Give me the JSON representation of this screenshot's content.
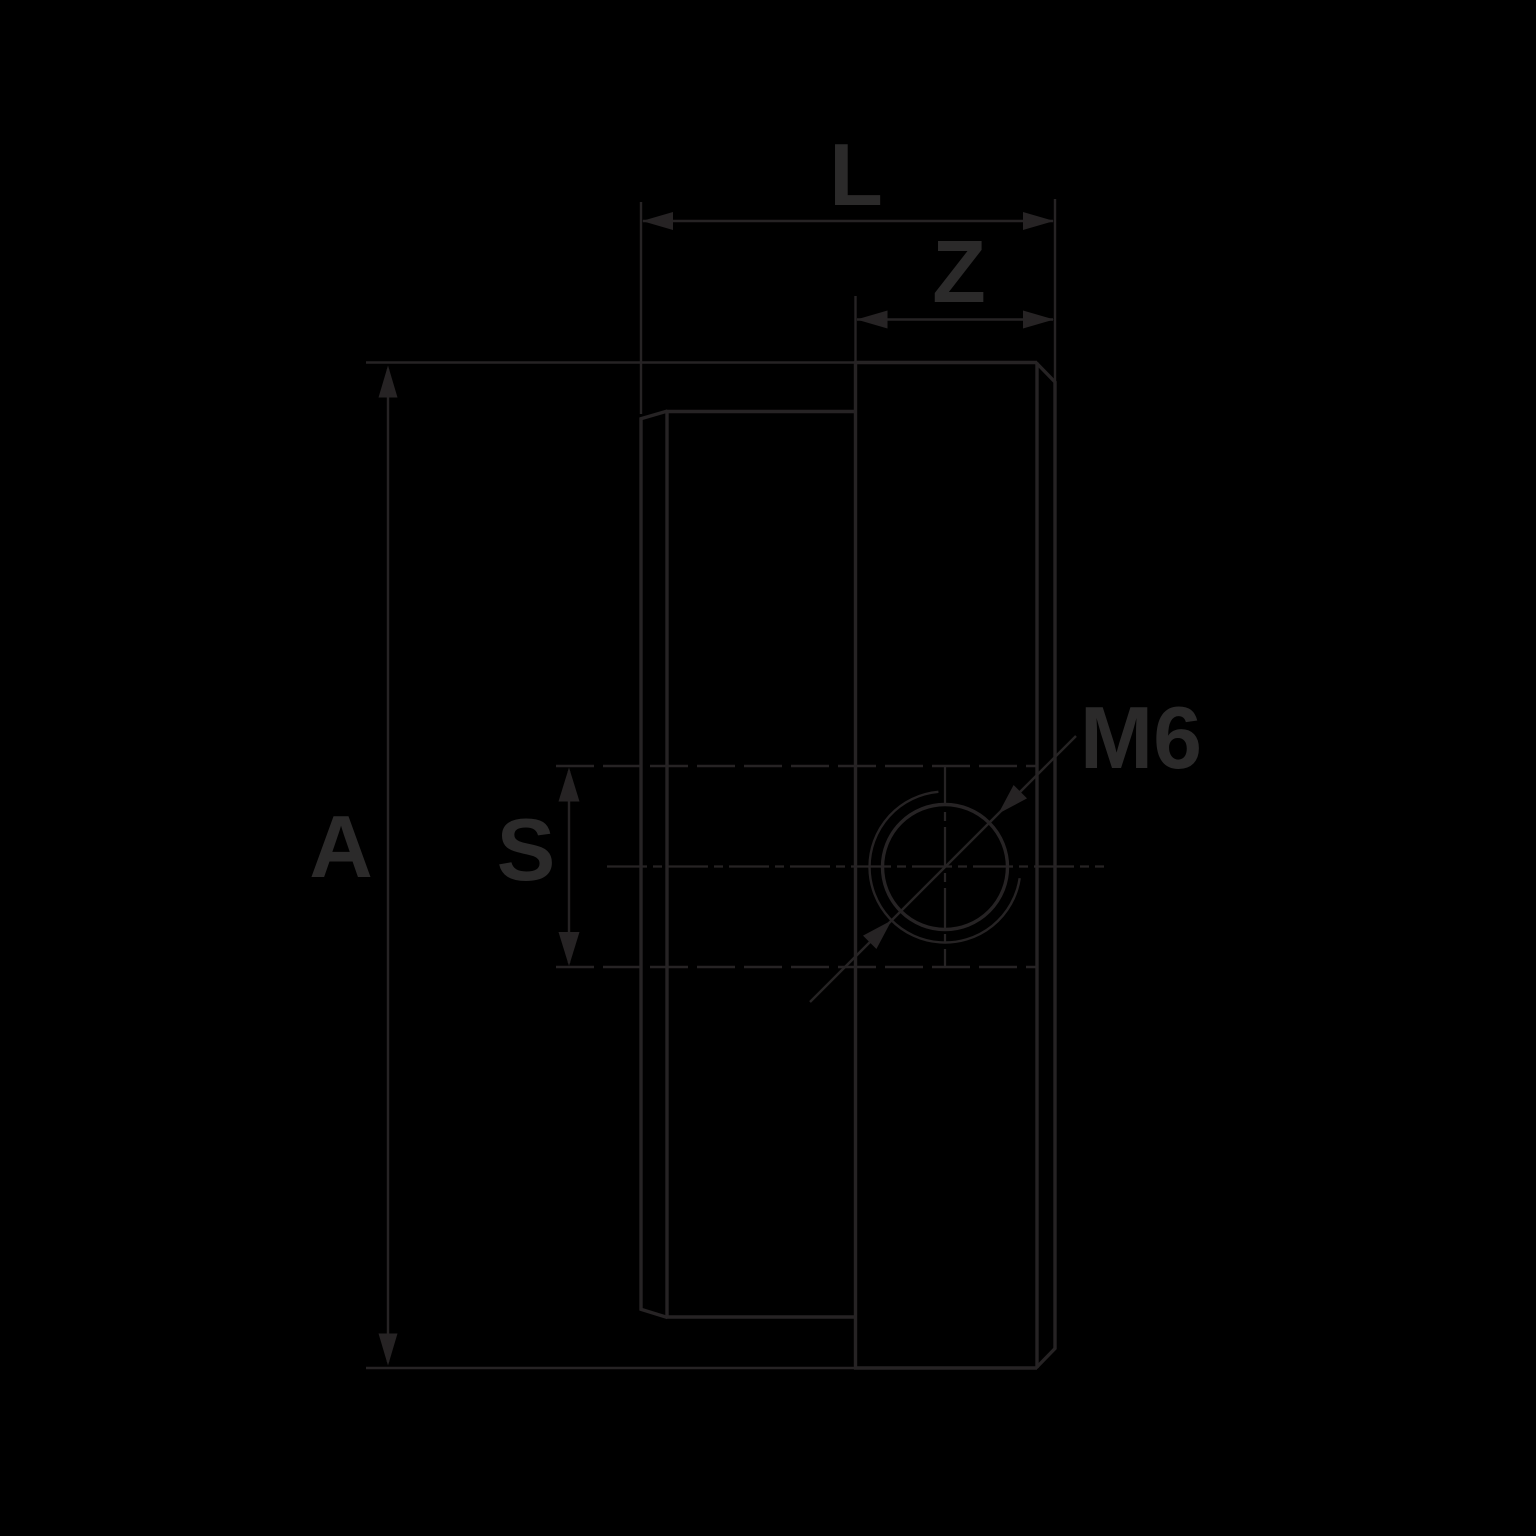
{
  "drawing": {
    "labels": {
      "overall_length": "L",
      "body_length": "Z",
      "overall_height": "A",
      "slot_width": "S",
      "thread_size": "M6"
    },
    "colors": {
      "background": "#000000",
      "line": "#262324",
      "text": "#2b2a2a"
    }
  }
}
